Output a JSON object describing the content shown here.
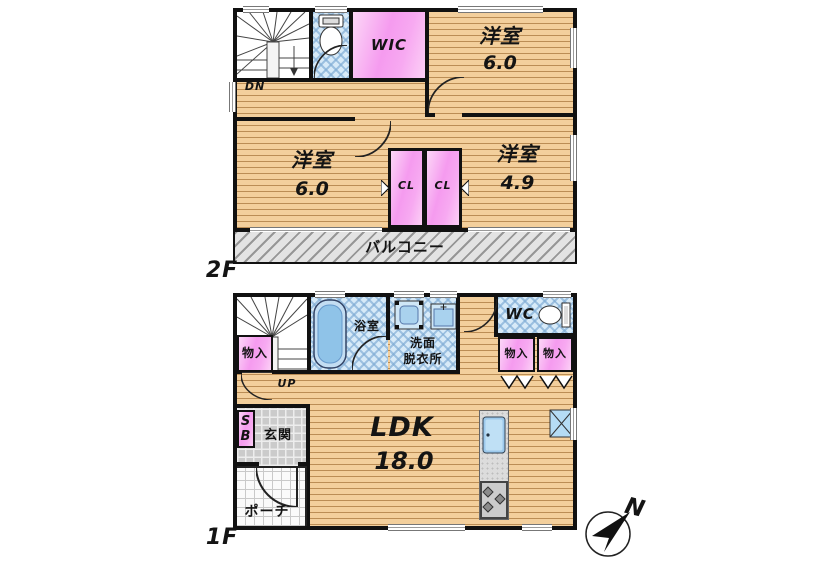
{
  "page": {
    "background": "#ffffff"
  },
  "colors": {
    "wall": "#111111",
    "wood_base": "#f3cf9c",
    "wood_line": "#bb8d55",
    "closet_pink": "#f59bef",
    "wet_room_blue": "#d7eaf8",
    "fixture_blue": "#8fc3e8",
    "balcony_gray": "#e3e3e3",
    "entrance_tile_gray": "#cbcbcb"
  },
  "floor2": {
    "label": "2F",
    "stairs_label": "DN",
    "rooms": {
      "wic": {
        "name": "WIC"
      },
      "bedroom_top": {
        "name": "洋室",
        "area": "6.0"
      },
      "bedroom_left": {
        "name": "洋室",
        "area": "6.0"
      },
      "bedroom_right": {
        "name": "洋室",
        "area": "4.9"
      },
      "closet1": {
        "name": "CL"
      },
      "closet2": {
        "name": "CL"
      },
      "balcony": {
        "name": "バルコニー"
      }
    }
  },
  "floor1": {
    "label": "1F",
    "stairs_label": "UP",
    "rooms": {
      "storage_stairs": {
        "name": "物入"
      },
      "bathroom": {
        "name": "浴室"
      },
      "washroom": {
        "line1": "洗面",
        "line2": "脱衣所"
      },
      "wc": {
        "name": "WC"
      },
      "storage1": {
        "name": "物入"
      },
      "storage2": {
        "name": "物入"
      },
      "shoebox": {
        "line1": "S",
        "line2": "B"
      },
      "entrance": {
        "name": "玄関"
      },
      "ldk": {
        "name": "LDK",
        "area": "18.0"
      },
      "porch": {
        "name": "ポーチ"
      }
    }
  },
  "compass": {
    "label": "N"
  }
}
